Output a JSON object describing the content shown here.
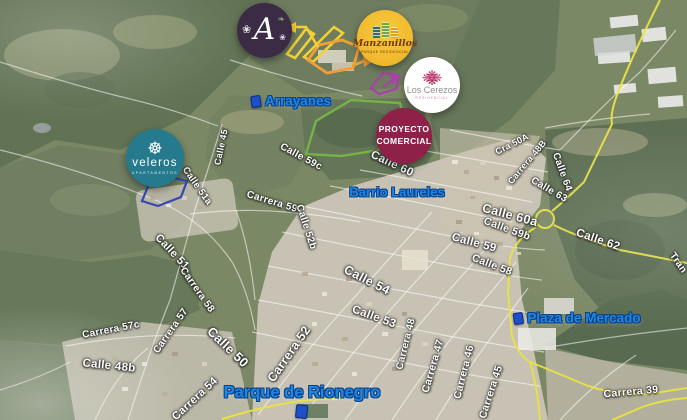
{
  "map": {
    "type": "satellite-promotional-map",
    "area_labels": [
      {
        "text": "Arrayanes",
        "x": 291,
        "y": 101,
        "size": 13.5,
        "marker": "left"
      },
      {
        "text": "Barrio Laureles",
        "x": 397,
        "y": 192,
        "size": 13,
        "marker": "none"
      },
      {
        "text": "Plaza de Mercado",
        "x": 577,
        "y": 318,
        "size": 13.5,
        "marker": "left"
      },
      {
        "text": "Parque de Rionegro",
        "x": 302,
        "y": 393,
        "size": 16.5,
        "marker": "below"
      }
    ],
    "street_labels": [
      {
        "text": "Calle 45",
        "x": 221,
        "y": 147,
        "rot": -78,
        "size": 9
      },
      {
        "text": "Calle 51a",
        "x": 197,
        "y": 186,
        "rot": 55,
        "size": 9.5
      },
      {
        "text": "Carrera 59",
        "x": 272,
        "y": 202,
        "rot": 17,
        "size": 10
      },
      {
        "text": "Calle 59c",
        "x": 301,
        "y": 157,
        "rot": 28,
        "size": 10
      },
      {
        "text": "Calle 60",
        "x": 392,
        "y": 164,
        "rot": 25,
        "size": 11.5
      },
      {
        "text": "Calle 52b",
        "x": 306,
        "y": 227,
        "rot": 72,
        "size": 10
      },
      {
        "text": "Calle 54",
        "x": 367,
        "y": 280,
        "rot": 27,
        "size": 12.5
      },
      {
        "text": "Calle 53",
        "x": 374,
        "y": 317,
        "rot": 20,
        "size": 11.5
      },
      {
        "text": "Calle 51",
        "x": 172,
        "y": 252,
        "rot": 47,
        "size": 11
      },
      {
        "text": "Carrera 58",
        "x": 197,
        "y": 290,
        "rot": 55,
        "size": 10
      },
      {
        "text": "Carrera 57",
        "x": 171,
        "y": 331,
        "rot": -55,
        "size": 10
      },
      {
        "text": "Carrera 57c",
        "x": 111,
        "y": 330,
        "rot": -11,
        "size": 10
      },
      {
        "text": "Calle 48b",
        "x": 109,
        "y": 366,
        "rot": 6,
        "size": 11.5
      },
      {
        "text": "Calle 50",
        "x": 228,
        "y": 347,
        "rot": 44,
        "size": 13
      },
      {
        "text": "Carrera 54",
        "x": 195,
        "y": 399,
        "rot": -43,
        "size": 11
      },
      {
        "text": "Carrera 52",
        "x": 289,
        "y": 354,
        "rot": -55,
        "size": 12.5
      },
      {
        "text": "Carrera 48",
        "x": 406,
        "y": 344,
        "rot": -76,
        "size": 10
      },
      {
        "text": "Carrera 47",
        "x": 433,
        "y": 366,
        "rot": -74,
        "size": 10.5
      },
      {
        "text": "Carrera 46",
        "x": 464,
        "y": 372,
        "rot": -76,
        "size": 10.5
      },
      {
        "text": "Carrera 45",
        "x": 491,
        "y": 392,
        "rot": -72,
        "size": 10.5
      },
      {
        "text": "Carrera 39",
        "x": 631,
        "y": 392,
        "rot": -5,
        "size": 10.5
      },
      {
        "text": "Cra 50A",
        "x": 512,
        "y": 144,
        "rot": -27,
        "size": 9
      },
      {
        "text": "Carrera 48B",
        "x": 527,
        "y": 162,
        "rot": -50,
        "size": 9
      },
      {
        "text": "Calle 64",
        "x": 562,
        "y": 172,
        "rot": 70,
        "size": 10
      },
      {
        "text": "Calle 63",
        "x": 549,
        "y": 190,
        "rot": 30,
        "size": 10
      },
      {
        "text": "Calle 60a",
        "x": 510,
        "y": 215,
        "rot": 15,
        "size": 12.5
      },
      {
        "text": "Calle 59b",
        "x": 507,
        "y": 229,
        "rot": 20,
        "size": 10.5
      },
      {
        "text": "Calle 59",
        "x": 474,
        "y": 243,
        "rot": 15,
        "size": 11.5
      },
      {
        "text": "Calle 58",
        "x": 492,
        "y": 265,
        "rot": 21,
        "size": 10.5
      },
      {
        "text": "Calle 62",
        "x": 598,
        "y": 240,
        "rot": 19,
        "size": 11.5
      },
      {
        "text": "Tran",
        "x": 678,
        "y": 263,
        "rot": 55,
        "size": 10
      }
    ],
    "badges": {
      "arrayanes": {
        "letter": "A"
      },
      "manzanillos": {
        "name": "Manzanillos",
        "subtitle": "PARQUE RESIDENCIAL"
      },
      "los_cerezos": {
        "name": "Los Cerezos",
        "subtitle": "RESIDENCIAL"
      },
      "proyecto_comercial": {
        "line1": "PROYECTO",
        "line2": "COMERCIAL"
      },
      "veleros": {
        "name": "veleros",
        "subtitle": "APARTAMENTOS"
      }
    },
    "icons": {
      "veleros_wheel": "☸",
      "cerezos_flower": "❋",
      "arrayanes_flower": "❀",
      "arrayanes_leaf": "❧"
    },
    "colors": {
      "route_yellow": "#e8e03a",
      "project_yellow_outline": "#f2cd2a",
      "project_orange_outline": "#ef9a2d",
      "project_purple_outline": "#a23aa0",
      "project_green_outline": "#6fae3e",
      "project_blue_outline": "#2c3dae",
      "area_label_blue": "#1e87e0",
      "badge_arrayanes_bg": "#3b2b45",
      "badge_manzanillos_bg": "#eeb026",
      "badge_cerezos_flower": "#b92f63",
      "badge_comercial_bg": "#8e2148",
      "badge_veleros_bg": "#257b8d"
    }
  }
}
